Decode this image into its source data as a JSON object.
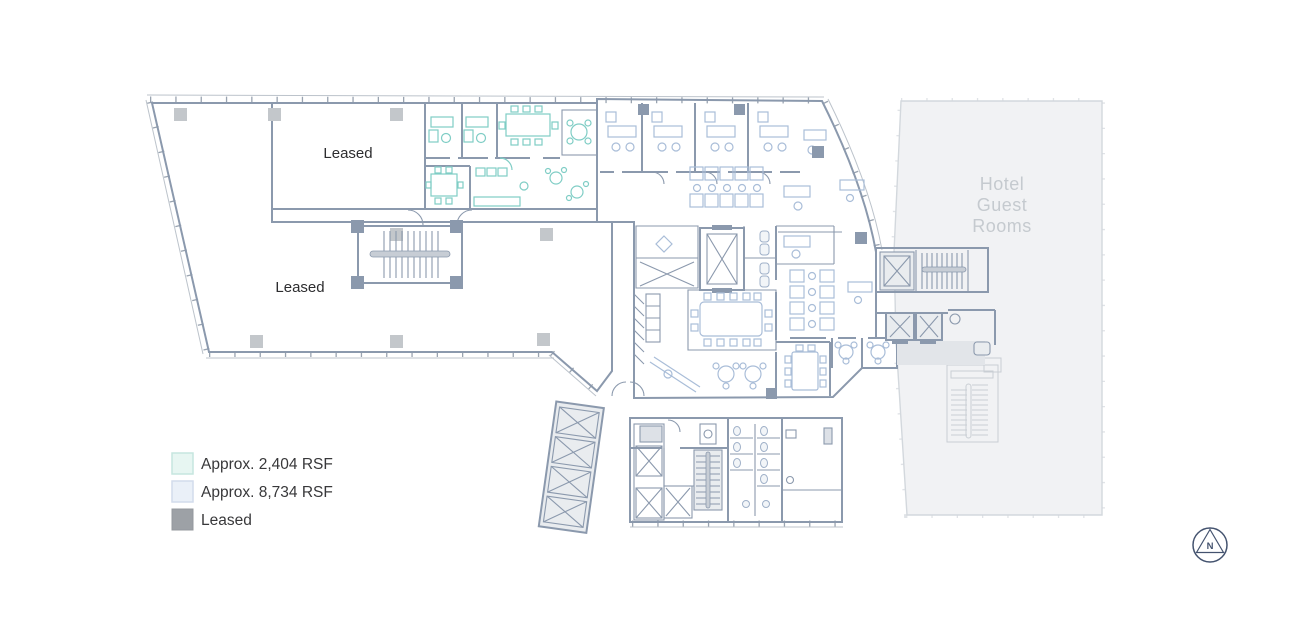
{
  "legend": {
    "items": [
      {
        "label": "Approx. 2,404 RSF",
        "color": "#e7f6f2",
        "border": "#c6e6df"
      },
      {
        "label": "Approx. 8,734 RSF",
        "color": "#eaf0f8",
        "border": "#d2dcec"
      },
      {
        "label": "Leased",
        "color": "#9da1a6",
        "border": "#94989d"
      }
    ],
    "text_color": "#38383a"
  },
  "floorplan": {
    "labels": {
      "leased_upper": "Leased",
      "leased_lower": "Leased"
    },
    "hotel": {
      "line1": "Hotel",
      "line2": "Guest",
      "line3": "Rooms"
    },
    "colors": {
      "leased": "#a4a8ad",
      "suite_mint": "#e7f6f2",
      "suite_blue": "#eaf0f8",
      "hotel_fill": "#f1f2f4",
      "core_fill": "#e6e9ed",
      "wall": "#8b99ad",
      "furniture_teal": "#7fcdc5",
      "furniture_blue": "#a9bdd8",
      "hotel_text": "#c5cacf",
      "label_text": "#2d2d2f"
    }
  },
  "compass": {
    "label": "N",
    "color": "#44536f"
  }
}
